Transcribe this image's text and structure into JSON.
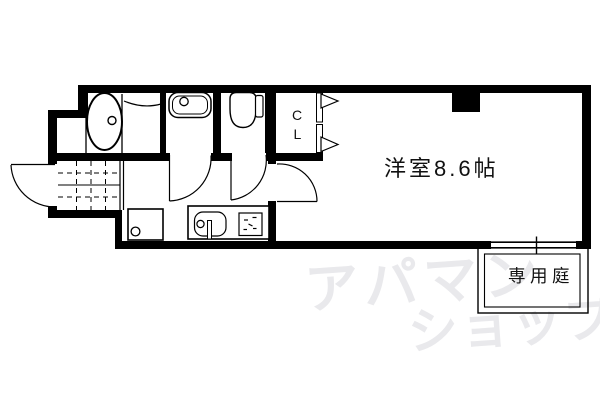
{
  "plan": {
    "room_label": "洋室8.6帖",
    "closet_label": {
      "line1": "C",
      "line2": "L"
    },
    "garden_label": "専用庭",
    "watermark": {
      "line1": "アパマン",
      "line2": "ショップ",
      "color": "#e9e9ec"
    },
    "colors": {
      "wall": "#000000",
      "line": "#000000",
      "background": "#ffffff"
    }
  }
}
